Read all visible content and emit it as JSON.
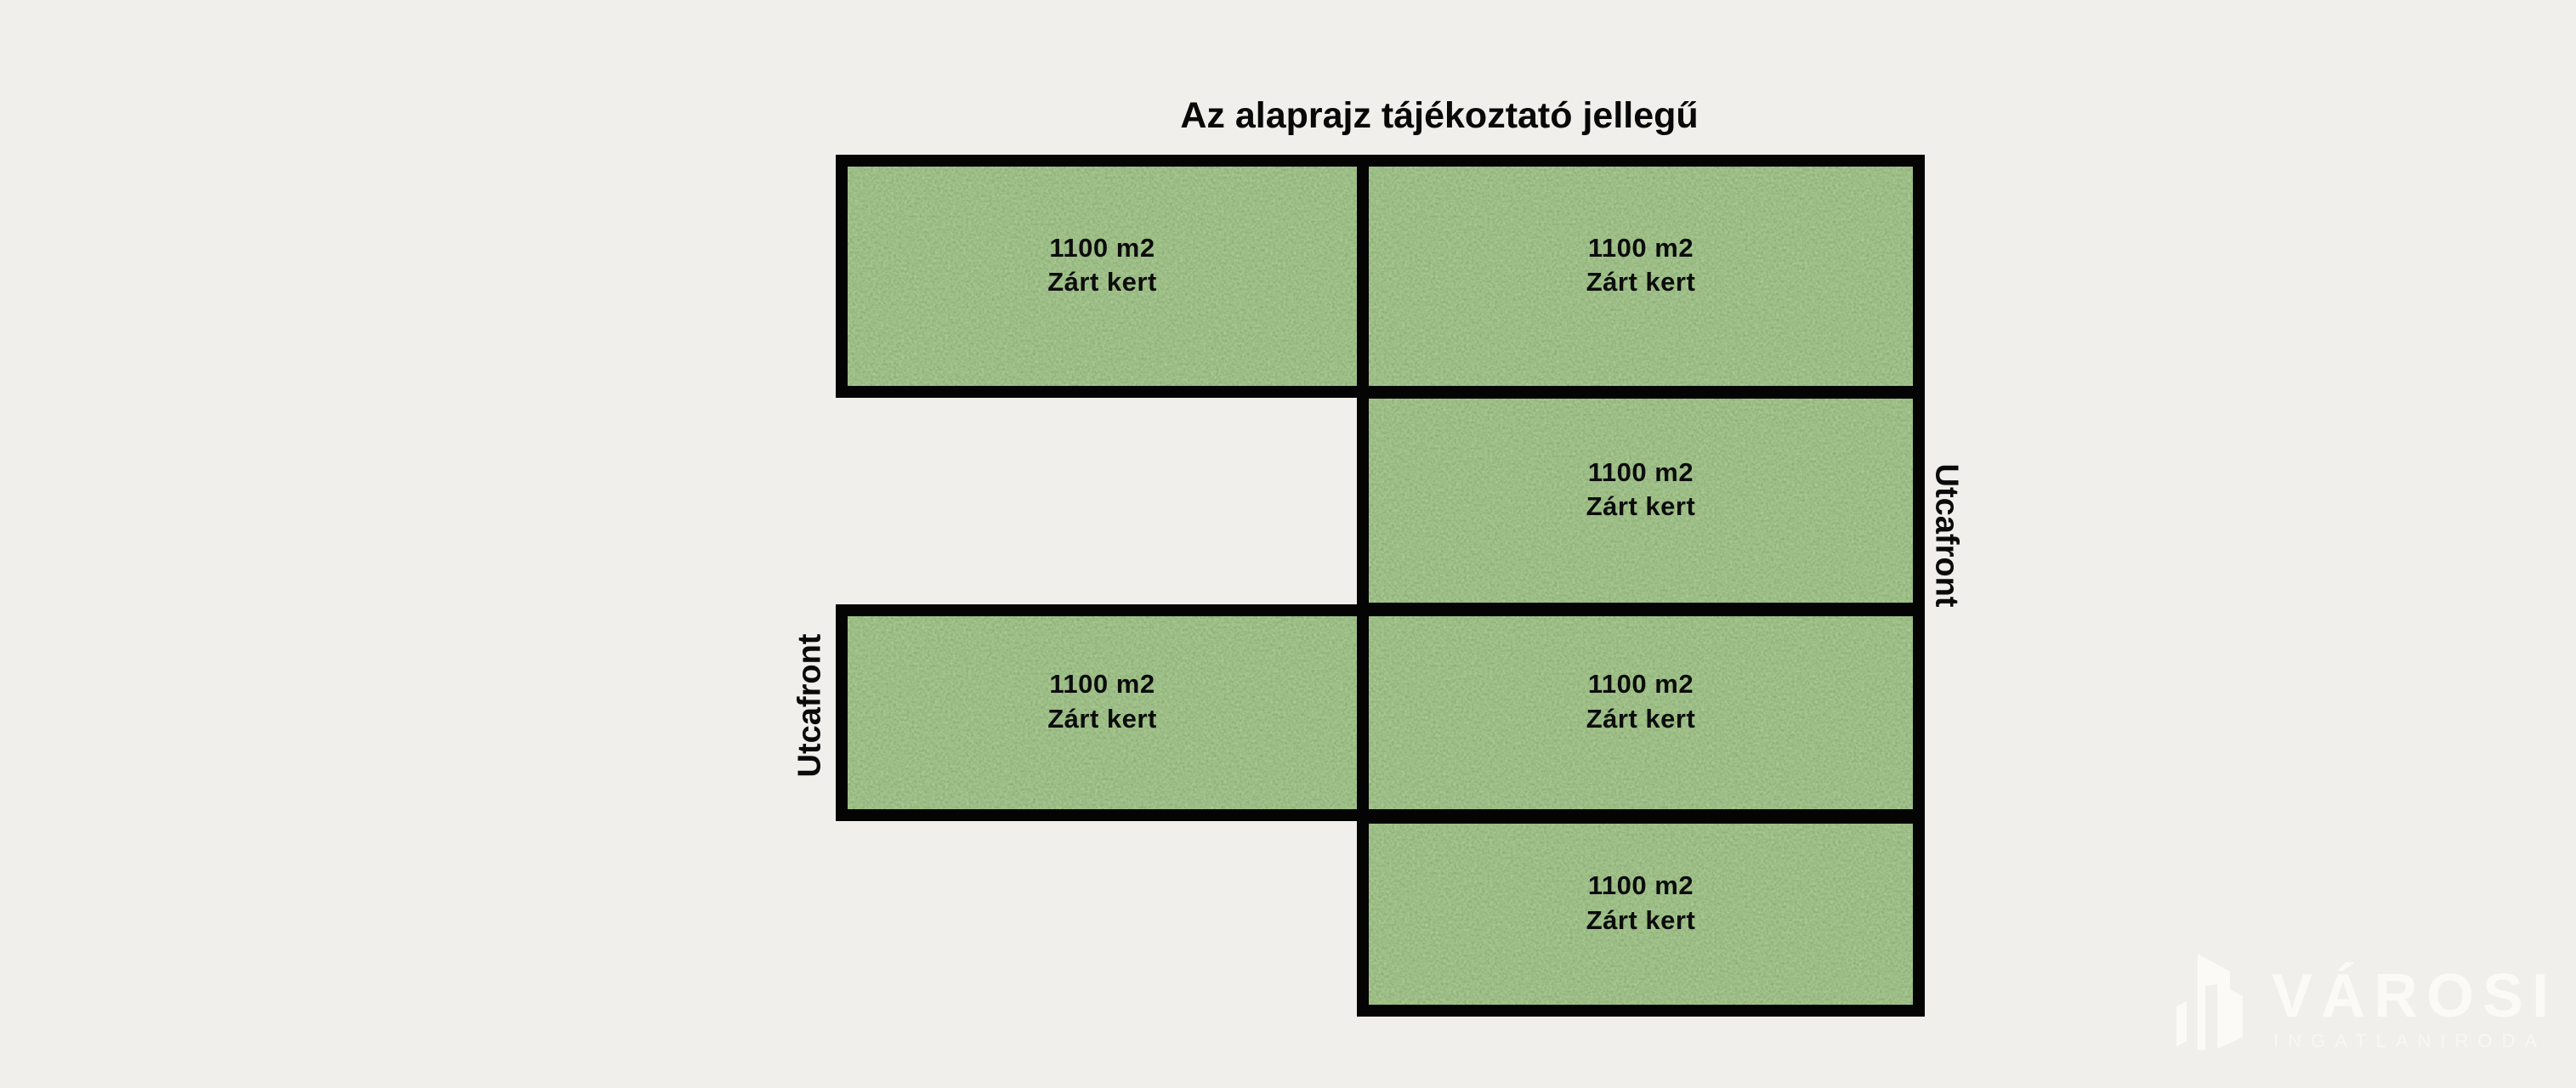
{
  "title": "Az alaprajz tájékoztató jellegű",
  "street_front": {
    "left_label": "Utcafront",
    "right_label": "Utcafront"
  },
  "plots": [
    {
      "position": "top-left",
      "area": "1100 m2",
      "type": "Zárt kert"
    },
    {
      "position": "top-right",
      "area": "1100 m2",
      "type": "Zárt kert"
    },
    {
      "position": "right-row2",
      "area": "1100 m2",
      "type": "Zárt kert"
    },
    {
      "position": "left-row3",
      "area": "1100 m2",
      "type": "Zárt kert"
    },
    {
      "position": "right-row3",
      "area": "1100 m2",
      "type": "Zárt kert"
    },
    {
      "position": "right-row4",
      "area": "1100 m2",
      "type": "Zárt kert"
    }
  ],
  "watermark": {
    "brand": "VÁROSI",
    "subtitle": "INGATLANIRODA"
  },
  "colors": {
    "background": "#f0efeb",
    "plot_green": "#55823f",
    "border": "#040404",
    "watermark": "#fbfaf6"
  }
}
